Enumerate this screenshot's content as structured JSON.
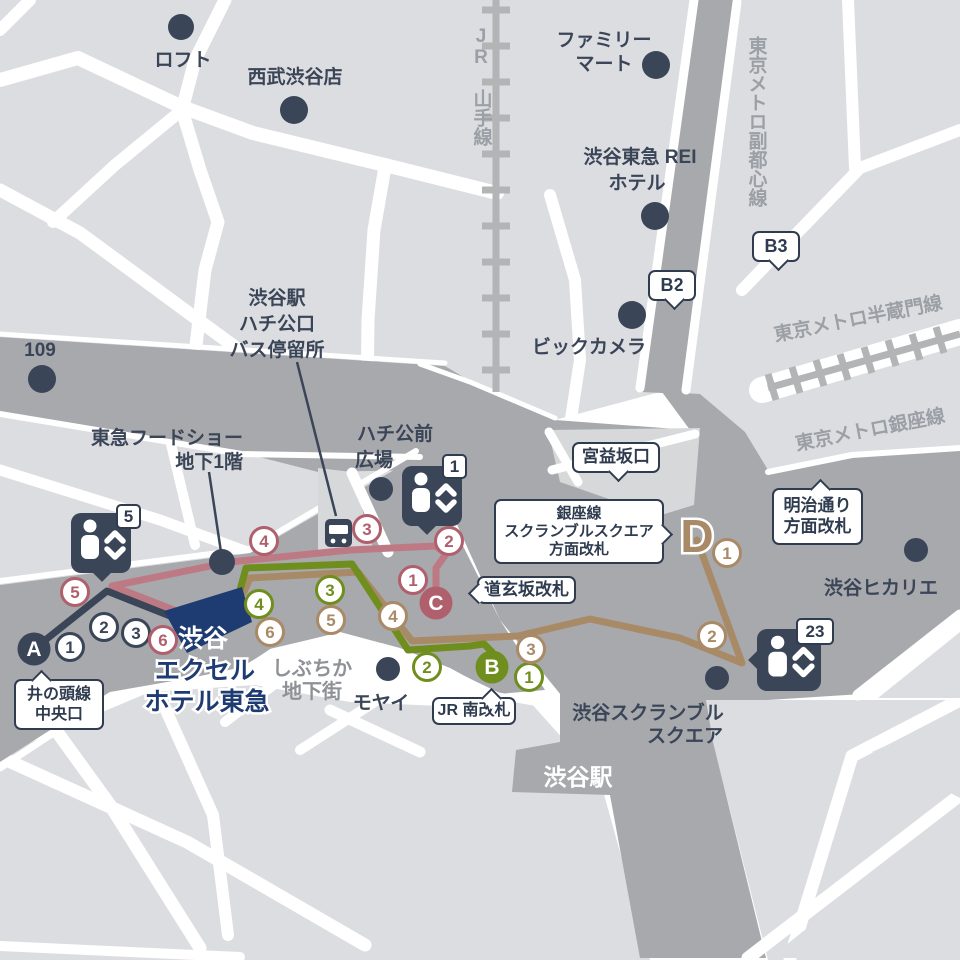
{
  "colors": {
    "navy": "#3a4557",
    "badge_navy": "#2f3b4f",
    "pink": "#b05f6c",
    "pink_line": "#bd7a84",
    "green": "#6f8e1d",
    "brown": "#a98a66",
    "hotel_blue": "#1e3c72",
    "block_light": "#dcdde0",
    "road_dark": "#a7a9ac",
    "rail_gray": "#b2b4b6",
    "gray_label": "#9ba0a6"
  },
  "places": {
    "loft": "ロフト",
    "seibu": "西武渋谷店",
    "familymart": {
      "line1": "ファミリー",
      "line2": "マート"
    },
    "rei_hotel": {
      "line1": "渋谷東急 REI",
      "line2": "ホテル"
    },
    "biccamera": "ビックカメラ",
    "one09": "109",
    "bus_stop": {
      "line1": "渋谷駅",
      "line2": "ハチ公口",
      "line3": "バス停留所"
    },
    "foodshow": {
      "line1": "東急フードショー",
      "line2": "地下1階"
    },
    "hachiko_square": {
      "line1": "ハチ公前",
      "line2": "広場"
    },
    "shibuchika": {
      "line1": "しぶちか",
      "line2": "地下街"
    },
    "moyai": "モヤイ",
    "scramble_square": {
      "line1": "渋谷スクランブル",
      "line2": "スクエア"
    },
    "hikarie": "渋谷ヒカリエ",
    "shibuya_station": "渋谷駅",
    "hotel": {
      "line1": "渋谷",
      "line2": "エクセル",
      "line3": "ホテル東急"
    }
  },
  "rails": {
    "jr_yamanote": "JR 山手線",
    "fukutoshin": "東京メトロ副都心線",
    "hanzomon": "東京メトロ半蔵門線",
    "ginza": "東京メトロ銀座線"
  },
  "gates": {
    "inokashira": {
      "line1": "井の頭線",
      "line2": "中央口"
    },
    "jr_south": "JR 南改札",
    "dogenzaka": "道玄坂改札",
    "ginza_scramble": {
      "line1": "銀座線",
      "line2": "スクランブルスクエア",
      "line3": "方面改札"
    },
    "miyamasuzaka": "宮益坂口",
    "meiji": {
      "line1": "明治通り",
      "line2": "方面改札"
    },
    "b2": "B2",
    "b3": "B3"
  },
  "exits": {
    "a": "A",
    "b": "B",
    "c": "C",
    "d": "D"
  },
  "elevators": {
    "e5": "5",
    "e1": "1",
    "e23": "23"
  },
  "routes": {
    "a": {
      "steps": [
        "1",
        "2",
        "3"
      ]
    },
    "b": {
      "steps": [
        "1",
        "2",
        "3",
        "4"
      ]
    },
    "c": {
      "steps": [
        "1",
        "2",
        "3",
        "4",
        "5",
        "6"
      ]
    },
    "d": {
      "steps": [
        "1",
        "2",
        "3",
        "4",
        "5",
        "6"
      ]
    }
  }
}
